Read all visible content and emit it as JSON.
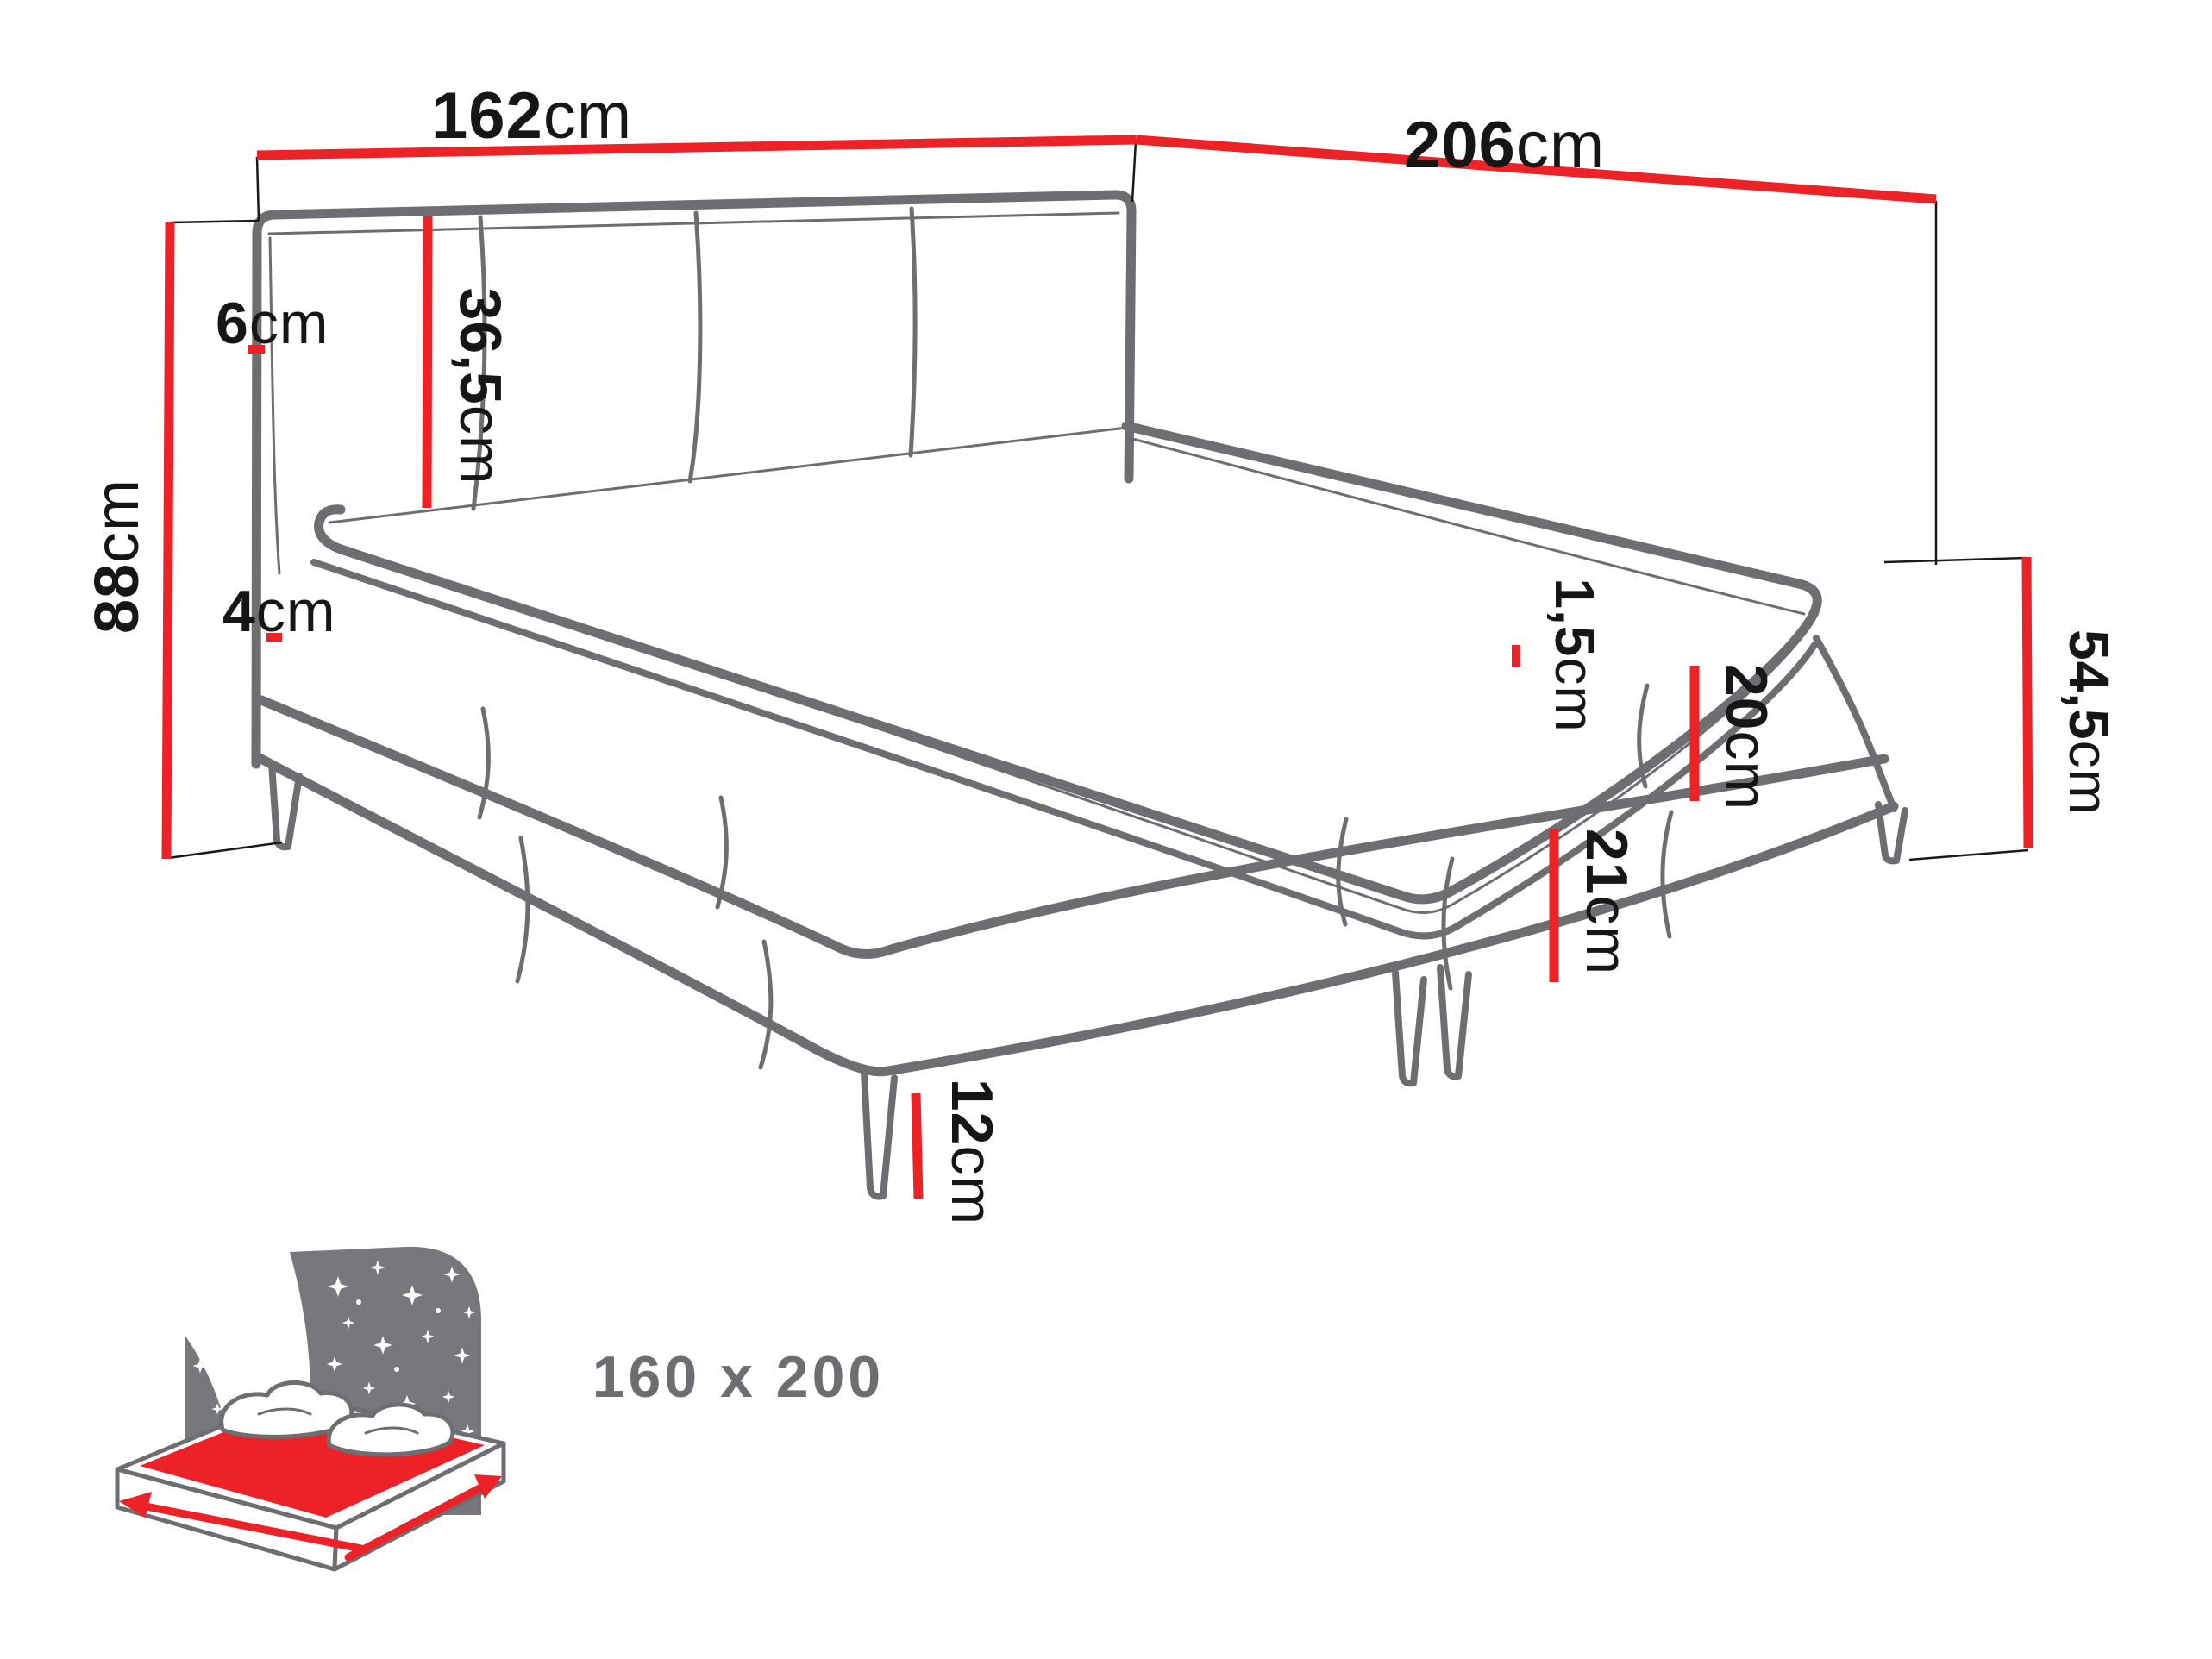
{
  "colors": {
    "dimension_red": "#ec2227",
    "bed_line_gray": "#6d6e71",
    "text_black": "#161616",
    "icon_gray": "#77787b",
    "background": "#ffffff"
  },
  "dims": {
    "width": {
      "value": "162",
      "unit": "cm"
    },
    "length": {
      "value": "206",
      "unit": "cm"
    },
    "headboard_height": {
      "value": "88",
      "unit": "cm"
    },
    "headboard_frame": {
      "value": "6",
      "unit": "cm"
    },
    "headboard_panel": {
      "value": "36,5",
      "unit": "cm"
    },
    "topper": {
      "value": "4",
      "unit": "cm"
    },
    "mattress_lip": {
      "value": "1,5",
      "unit": "cm"
    },
    "upper_box": {
      "value": "20",
      "unit": "cm"
    },
    "lower_box": {
      "value": "21",
      "unit": "cm"
    },
    "side_height": {
      "value": "54,5",
      "unit": "cm"
    },
    "leg": {
      "value": "12",
      "unit": "cm"
    }
  },
  "footer": {
    "size_label": "160 x 200"
  }
}
